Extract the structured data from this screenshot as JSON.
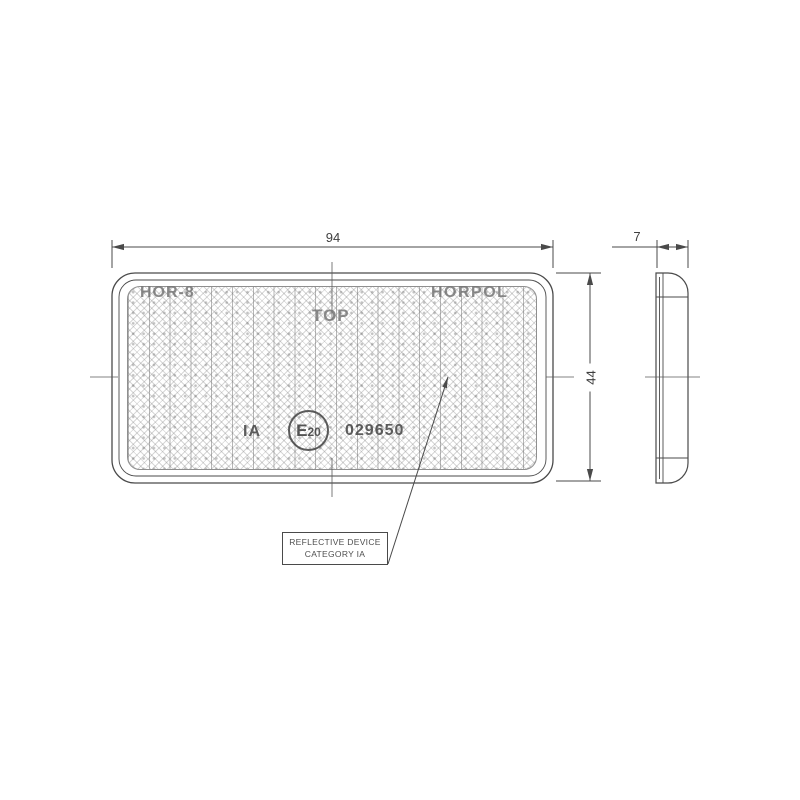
{
  "dimensions": {
    "width": "94",
    "height": "44",
    "thickness": "7"
  },
  "markings": {
    "model": "HOR-8",
    "brand": "HORPOL",
    "orientation": "TOP",
    "category": "IA",
    "e_mark_letter": "E",
    "e_mark_number": "20",
    "approval_number": "029650"
  },
  "callout": {
    "line1": "REFLECTIVE DEVICE",
    "line2": "CATEGORY IA"
  },
  "colors": {
    "line": "#4a4a4a",
    "dimension_text": "#3f3f3f",
    "emboss_text": "#767676",
    "emboss_dark_text": "#4b4b4b",
    "texture": "#6e6e6e"
  }
}
